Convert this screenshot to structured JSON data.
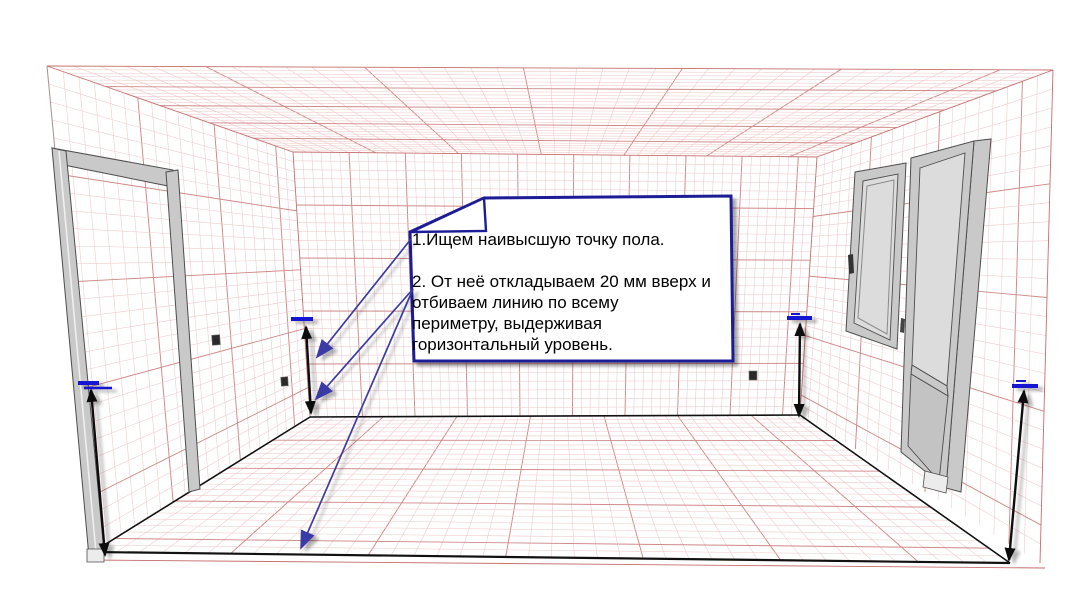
{
  "callout": {
    "step1": "1.Ищем наивысшую точку пола.",
    "step2_lines": [
      "2. От неё откладываем 20 мм вверх и",
      "отбиваем линию по всему",
      "периметру, выдерживая",
      "горизонтальный уровень."
    ]
  },
  "colors": {
    "ink": "#111111",
    "tick_blue": "#1414d2",
    "arrow_blue": "#3b3ba6",
    "box_navy": "#1c1c96",
    "box_fill": "#ffffff",
    "grid_minor": "#eec9c9",
    "grid_major": "#d08888",
    "edge_red": "#c76e6e",
    "frame_fill": "#c9c9c9",
    "frame_stroke": "#4d4d4d",
    "glass_fill": "#dcdcdc",
    "panel_fill": "#c3c3c3",
    "outlet_dark": "#2a2a2a",
    "text_black": "#000000"
  }
}
